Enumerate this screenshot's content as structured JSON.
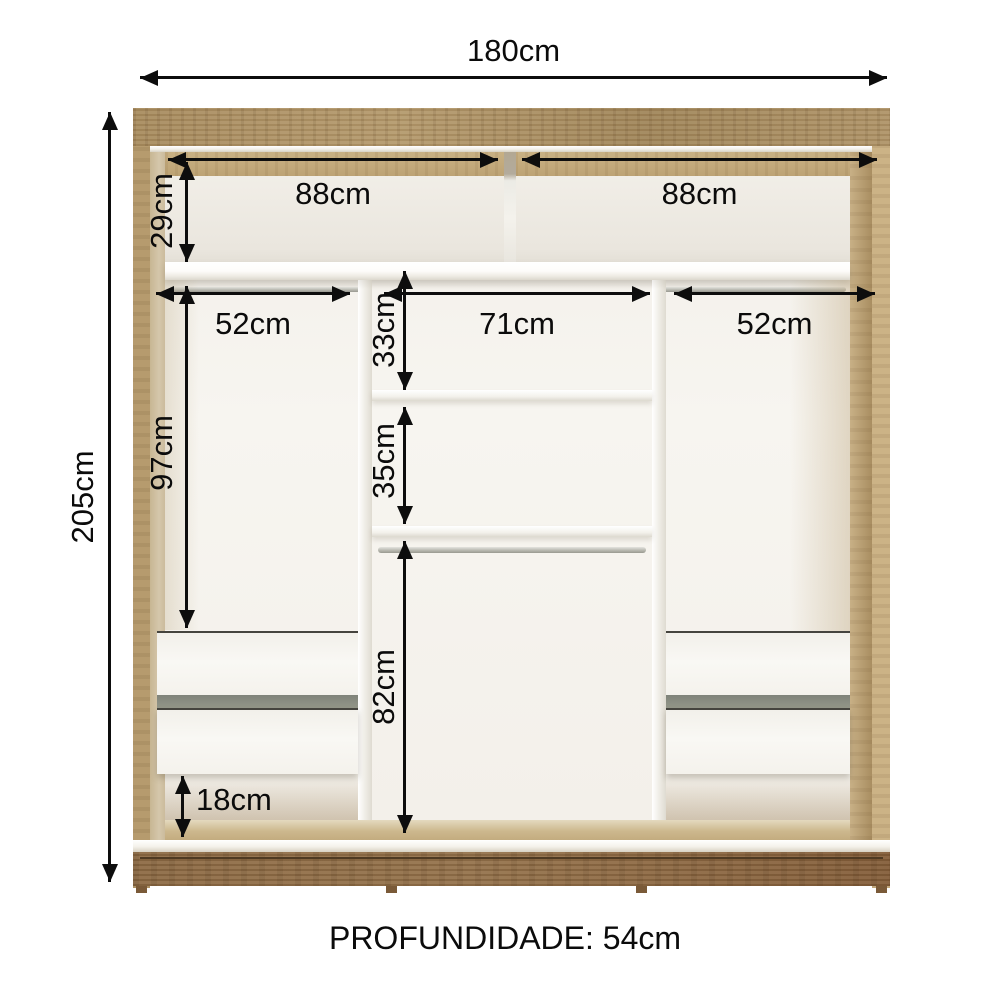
{
  "diagram": {
    "type": "wardrobe-interior-dimension-diagram",
    "dimensions": {
      "total_width": "180cm",
      "total_height": "205cm",
      "top_left_section_width": "88cm",
      "top_right_section_width": "88cm",
      "top_section_height": "29cm",
      "left_rod_width": "52cm",
      "center_section_width": "71cm",
      "right_rod_width": "52cm",
      "center_upper_cubby_height": "33cm",
      "center_lower_cubby_height": "35cm",
      "left_hanging_height": "97cm",
      "center_hanging_height": "82cm",
      "under_drawer_clearance": "18cm"
    },
    "footer": {
      "depth_label": "PROFUNDIDADE: 54cm"
    },
    "colors": {
      "wood_light": "#ab9064",
      "wood_side_inner": "#d0c2a5",
      "wood_base_dark": "#8a6843",
      "interior_white": "#f5f3ee",
      "drawer_gap_gray": "#8e9187",
      "dimension_ink": "#0d0d0d",
      "background": "#ffffff"
    }
  }
}
